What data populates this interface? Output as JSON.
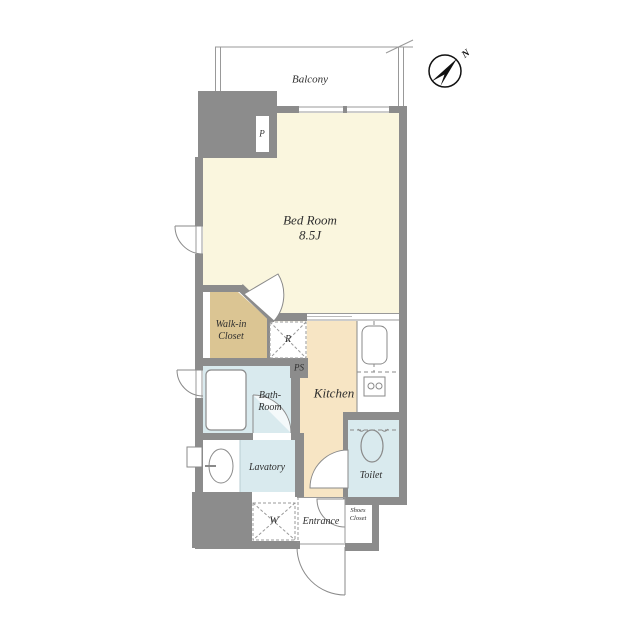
{
  "floorplan": {
    "title_hint": "apartment-floor-plan",
    "compass": {
      "north_label": "N"
    },
    "rooms": {
      "balcony": "Balcony",
      "bedroom_name": "Bed Room",
      "bedroom_size": "8.5J",
      "walkin_closet_line1": "Walk-in",
      "walkin_closet_line2": "Closet",
      "kitchen": "Kitchen",
      "bath_line1": "Bath-",
      "bath_line2": "Room",
      "lavatory": "Lavatory",
      "toilet": "Toilet",
      "entrance": "Entrance",
      "shoes_closet_line1": "Shoes",
      "shoes_closet_line2": "Closet"
    },
    "marks": {
      "pipe": "P",
      "pipe_space": "PS",
      "refrigerator": "R",
      "washer": "W"
    },
    "colors": {
      "wall": "#8c8c8c",
      "bedroom_floor": "#faf6de",
      "closet_floor": "#dbc593",
      "kitchen_floor": "#f7e5c4",
      "wet_area_floor": "#d9eaee",
      "thin_line": "#999999",
      "text": "#2e2e2e"
    }
  }
}
